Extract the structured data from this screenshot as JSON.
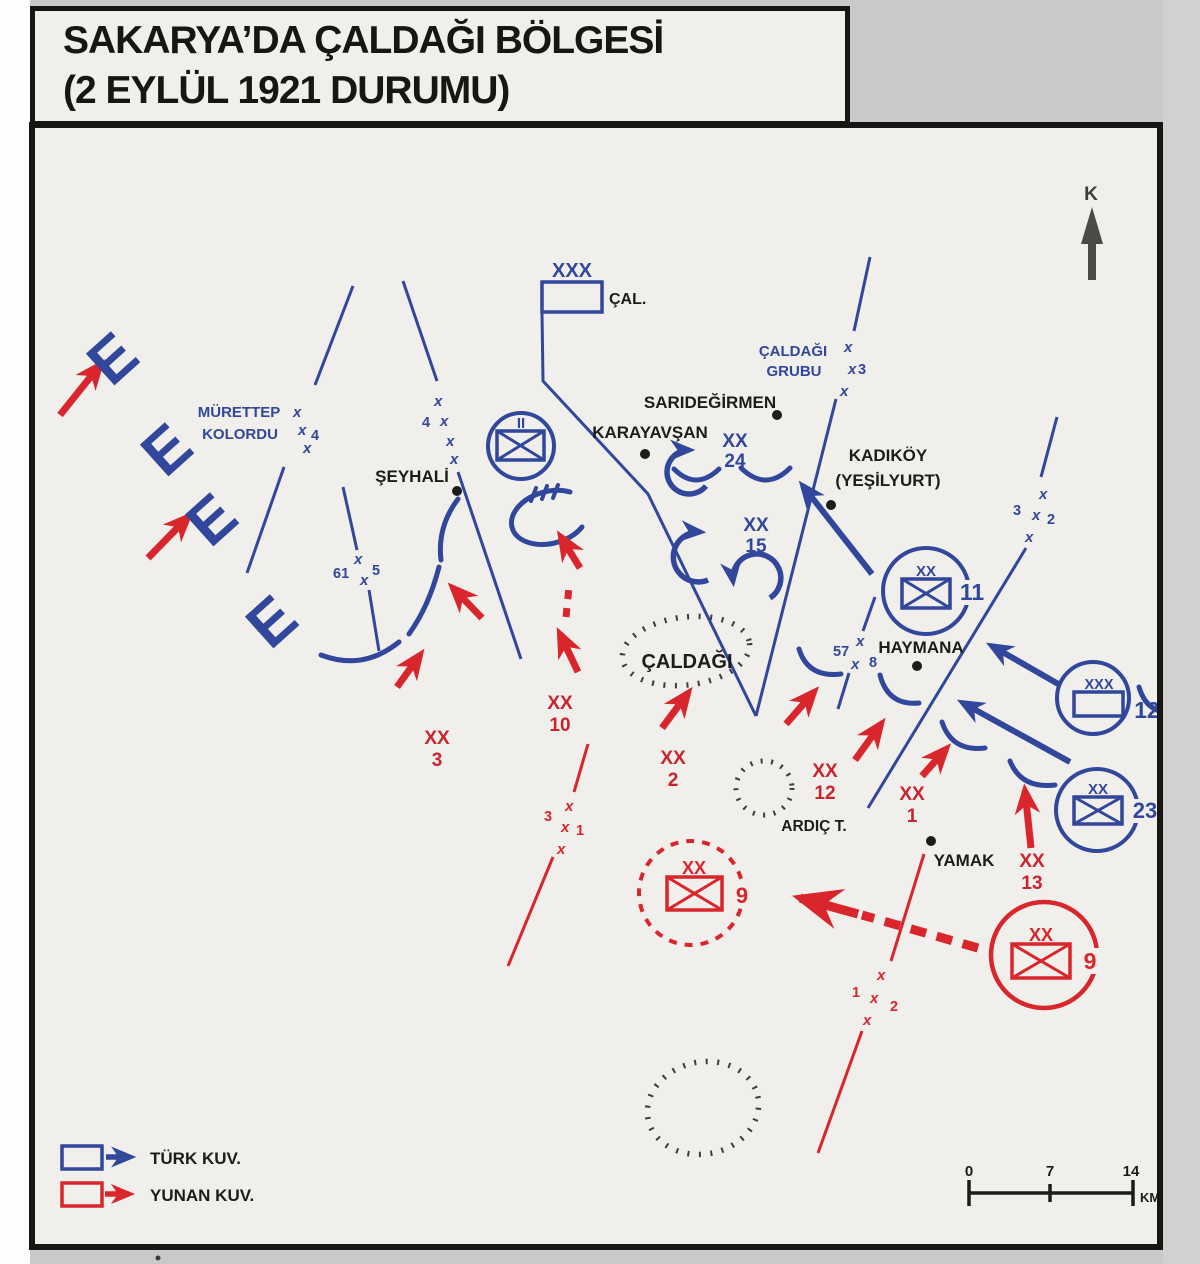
{
  "title": {
    "line1": "SAKARYA’DA ÇALDAĞI BÖLGESİ",
    "line2": "(2 EYLÜL 1921 DURUMU)"
  },
  "north_label": "K",
  "corps_hq": {
    "echelon": "XXX",
    "name": "ÇAL."
  },
  "formation_labels": {
    "murettep_line1": "MÜRETTEP",
    "murettep_line2": "KOLORDU",
    "grubu_line1": "ÇALDAĞI",
    "grubu_line2": "GRUBU"
  },
  "turkish_units": {
    "div24_echelon": "XX",
    "div24_number": "24",
    "div15_echelon": "XX",
    "div15_number": "15",
    "div11_echelon": "XX",
    "div11_number": "11",
    "group12_echelon": "XXX",
    "group12_number": "12",
    "div23_echelon": "XX",
    "div23_number": "23",
    "circled_battalion_echelon": "II"
  },
  "greek_units": {
    "div3_echelon": "XX",
    "div3_number": "3",
    "div10_echelon": "XX",
    "div10_number": "10",
    "div2_echelon": "XX",
    "div2_number": "2",
    "div12_echelon": "XX",
    "div12_number": "12",
    "div1_echelon": "XX",
    "div1_number": "1",
    "div13_echelon": "XX",
    "div13_number": "13",
    "div9_echelon": "XX",
    "div9_number": "9",
    "div9_objective_echelon": "XX",
    "div9_objective_number": "9"
  },
  "boundary_numbers": {
    "left4": "4",
    "right4": "4",
    "n61": "61",
    "n5": "5",
    "grubu3": "3",
    "right3": "3",
    "right2": "2",
    "n57": "57",
    "n8": "8",
    "red3": "3",
    "red1a": "1",
    "red1b": "1",
    "red2": "2",
    "x": "x"
  },
  "places": {
    "sarigedirmen": "SARIDEĞİRMEN",
    "karayavsan": "KARAYAVŞAN",
    "kadikoy": "KADIKÖY",
    "yesilyurt": "(YEŞİLYURT)",
    "seyhali": "ŞEYHALİ",
    "haymana": "HAYMANA",
    "yamak": "YAMAK"
  },
  "terrain": {
    "caldagi": "ÇALDAĞI",
    "ardic": "ARDIÇ T."
  },
  "trench_glyph": "E",
  "legend": {
    "turkish": "TÜRK KUV.",
    "greek": "YUNAN KUV."
  },
  "scale_bar": {
    "tick0": "0",
    "tick1": "7",
    "tick2": "14",
    "unit": "KM"
  },
  "colors": {
    "turkish_blue": "#31479b",
    "greek_red": "#d8262c",
    "ink": "#1c1c1a",
    "map_bg": "#f0efeb",
    "terrain_dots": "#3c3c3a",
    "north_gray": "#4a4a48"
  }
}
